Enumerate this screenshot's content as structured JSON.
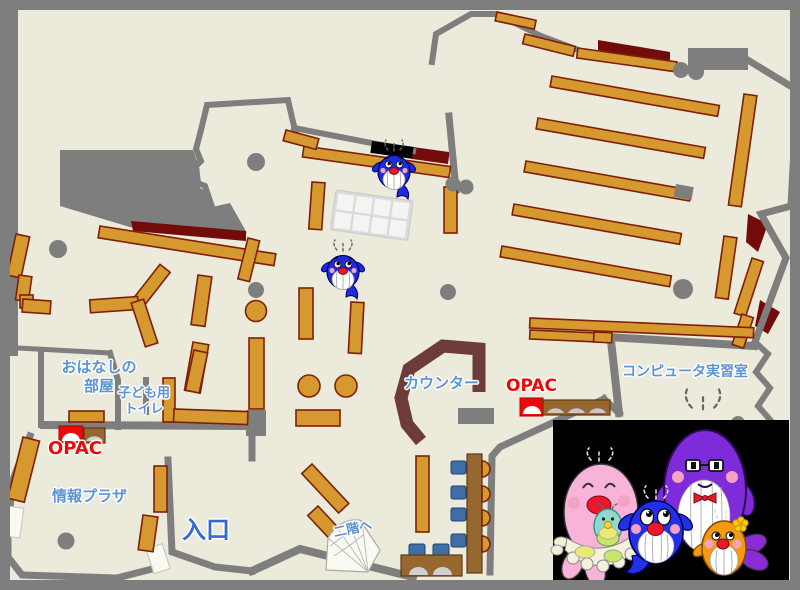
{
  "labels": {
    "storytelling_room": {
      "line1": "おはなしの",
      "line2": "部屋"
    },
    "kids_toilet": {
      "line1": "子ども用",
      "line2": "トイレ"
    },
    "opac": "OPAC",
    "info_plaza": "情報プラザ",
    "entrance": "入口",
    "counter": "カウンター",
    "to_second_floor": "二階へ",
    "computer_room": "コンピュータ実習室"
  },
  "palette": {
    "floor": "#ECEADB",
    "wall": "#7E7E7E",
    "bookshelf": "#D6992F",
    "bookshelf_outline": "#7E1F08",
    "carpet_dark_red": "#730B0B",
    "counter_maroon": "#6E3B3B",
    "furniture_brown": "#96672F",
    "chair_blue": "#3D6FA5",
    "opac_red": "#EA0A0A",
    "label_blue": "#5B93D5",
    "entrance_blue": "#2E6BD8",
    "mascot_panel": "#000000",
    "whale_blue": "#1D2BE0",
    "mascot_pink": "#F7B3D8",
    "mascot_purple": "#7E2BDA",
    "mascot_orange": "#F49A12",
    "mascot_teal": "#8FD8CC"
  },
  "mascots": {
    "on_map": [
      "blue-whale-mascot",
      "blue-whale-mascot"
    ],
    "panel": [
      "pink-sea-mascot",
      "baby-teal-mascot",
      "blue-whale-mascot",
      "purple-whale-mascot",
      "orange-fish-mascot"
    ]
  }
}
